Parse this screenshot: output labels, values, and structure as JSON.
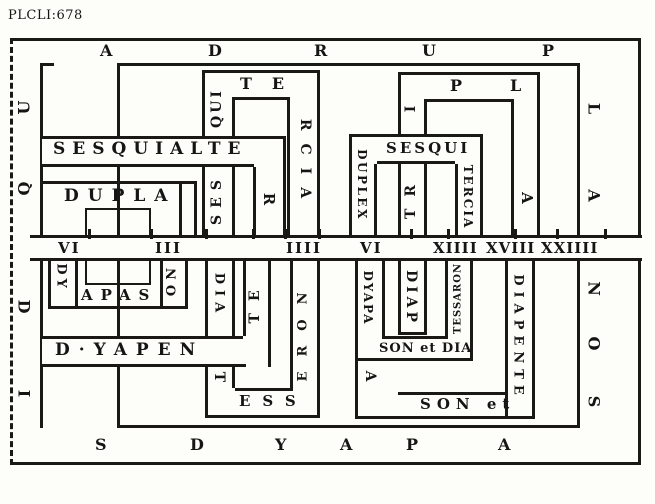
{
  "page_label": "PLCLI:678",
  "border_ring": {
    "top": [
      "A",
      "D",
      "R",
      "U",
      "P"
    ],
    "left_upper": [
      "U",
      "Q"
    ],
    "left_lower": [
      "D",
      "I"
    ],
    "right_upper": [
      "L",
      "A"
    ],
    "right_lower": [
      "N",
      "O",
      "S"
    ],
    "bottom": [
      "S",
      "D",
      "Y",
      "A",
      "P",
      "A"
    ]
  },
  "number_line": {
    "values": [
      "VI",
      "III",
      "IIII",
      "VI",
      "XIIII",
      "XVIII",
      "XXIIII"
    ]
  },
  "upper_left": {
    "dupla_label": "DUPLA",
    "sesquialtera": {
      "band": "SESQUIALTE",
      "leg": "R"
    },
    "sesquitercia": {
      "leg_left_lower": "SES",
      "leg_left_upper": "QUI",
      "top": "TE",
      "leg_right": "RCIA"
    }
  },
  "upper_right": {
    "tripla": {
      "leg_left_lower": "TR",
      "leg_left_upper": "I",
      "top": "PL",
      "leg_right": "A"
    },
    "duplex_sesquitercia": {
      "leg_left": "DUPLEX",
      "band": "SESQUI",
      "leg_right": "TERCIA"
    }
  },
  "lower_left": {
    "dyapason": {
      "leg_left": "DY",
      "band": "APAS",
      "leg_right": "ON"
    },
    "dyapente": {
      "band": "D·YAPEN",
      "leg_right": "TE"
    },
    "diatesseron": {
      "leg_left": "DIA",
      "bend": "T",
      "band": "ESS",
      "leg_right": "ERON"
    }
  },
  "lower_right": {
    "dyapason_diatessaron": {
      "leg_left": "DYAPA",
      "band": "SON et DIA",
      "leg_right": "TESSARON"
    },
    "diapason_diapente": {
      "leg_left_upper": "DIAP",
      "leg_left_lower": "A",
      "band": "SON et",
      "leg_right": "DIAPENTE"
    }
  },
  "colors": {
    "ink": "#1b1916",
    "paper": "#fdfdfa"
  }
}
